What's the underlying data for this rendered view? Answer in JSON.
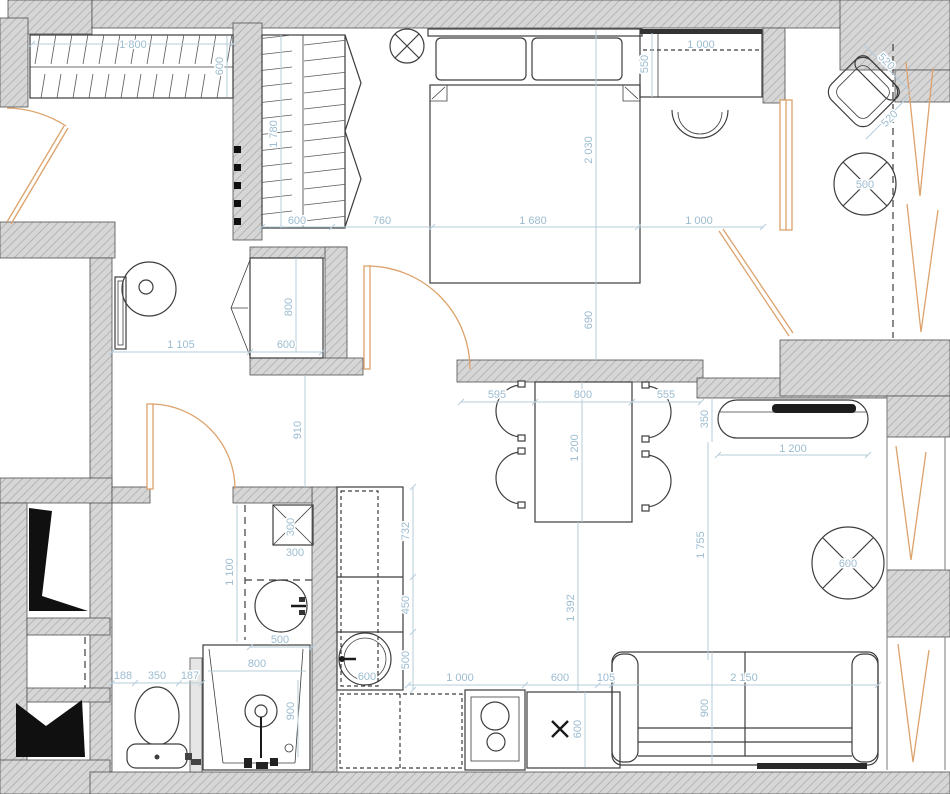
{
  "plan": {
    "colors": {
      "dimension_text": "#9cbcd0",
      "dimension_line": "#b6cdda",
      "wall_fill": "#d6d6d6",
      "wall_hatch": "#a8a8a8",
      "outline": "#4f4f4f",
      "furniture": "#3d3d3d",
      "door_accent": "#dda26b",
      "shaft_fill": "#101010"
    },
    "icons": {
      "ceiling_light_icon": "circle-with-cross",
      "round_table_icon": "circle-with-diagonals",
      "appliance_slot_icon": "x-mark",
      "door_swing_icon": "quarter-arc",
      "curtain_icon": "thin-triangle",
      "shaft_icon": "black-polygon"
    },
    "dimensions": {
      "hall": {
        "wardrobe_width": "1 800",
        "wardrobe_depth": "600",
        "hall_width": "1 105",
        "cabinet_width": "600",
        "cabinet_depth": "800",
        "corridor_width": "910"
      },
      "closet": {
        "length": "1 780",
        "width": "600"
      },
      "bedroom": {
        "closet_to_bed": "760",
        "bed_width": "1 680",
        "bed_length": "2 030",
        "bed_to_wall": "690",
        "bed_to_window": "1 000",
        "desk_width": "1 000",
        "desk_depth": "550"
      },
      "balcony": {
        "chair_width": "520",
        "chair_depth": "520",
        "table_diameter": "500"
      },
      "dining": {
        "chairs_left": "595",
        "table_width": "800",
        "chairs_right": "555",
        "table_length": "1 200",
        "table_to_kitchen": "1 392"
      },
      "living": {
        "console_depth": "350",
        "console_width": "1 200",
        "room_length": "1 755",
        "side_table_diameter": "600",
        "sofa_width": "2 150",
        "sofa_depth": "900"
      },
      "kitchen": {
        "upper_run": "732",
        "mid_run": "450",
        "low_run": "500",
        "sink_diameter": "600",
        "counter_run": "1 000",
        "appliance_width": "600",
        "gap": "105",
        "appliance_depth": "600"
      },
      "bathroom": {
        "shelf_depth": "300",
        "shelf_width": "300",
        "vanity_run": "1 100",
        "vanity_width": "500",
        "shower_width": "800",
        "shower_depth": "900",
        "toilet_left": "188",
        "toilet_width": "350",
        "toilet_right": "187"
      }
    }
  }
}
